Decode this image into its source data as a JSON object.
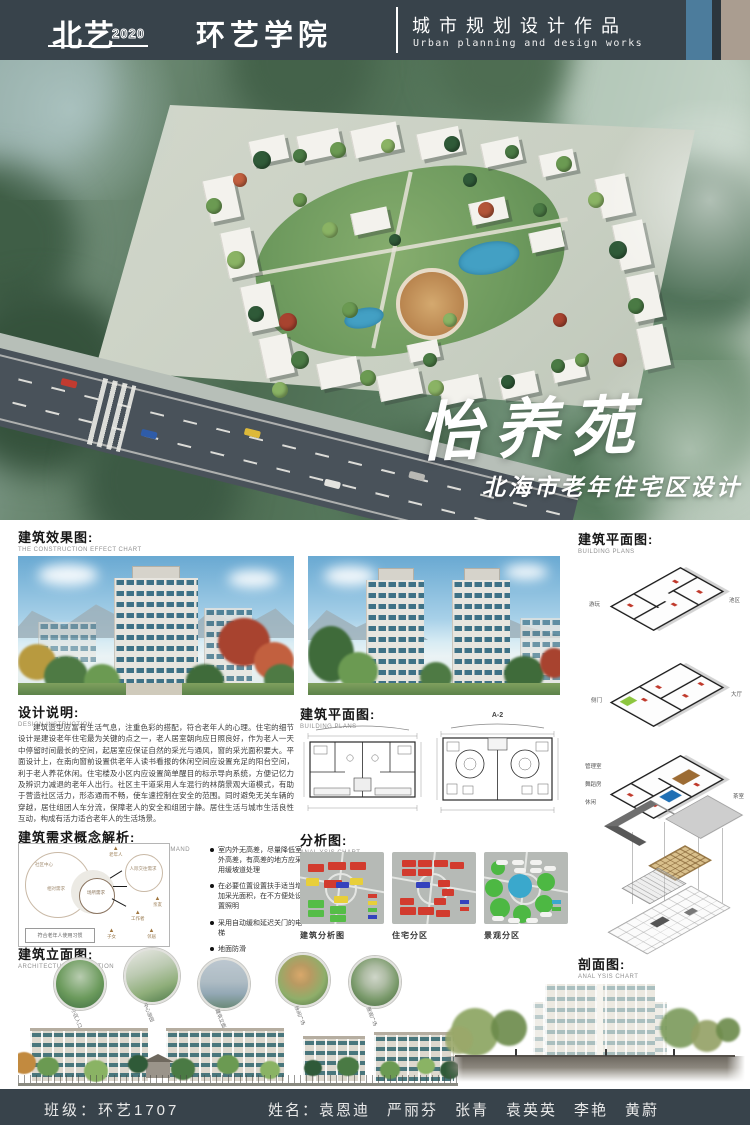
{
  "header": {
    "brand": "北艺",
    "brand_year": "2020",
    "department": "环艺学院",
    "category_cn": "城市规划设计作品",
    "category_en": "Urban planning and design works"
  },
  "hero": {
    "title": "怡养苑",
    "subtitle": "北海市老年住宅区设计"
  },
  "sections": {
    "effect": {
      "cn": "建筑效果图:",
      "en": "THE CONSTRUCTION EFFECT CHART"
    },
    "plans_right": {
      "cn": "建筑平面图:",
      "en": "BUILDING PLANS",
      "p1l": "游玩",
      "p1r": "池区",
      "p2l": "侧门",
      "p2r": "大厅",
      "p3l1": "管理室",
      "p3l2": "舞蹈房",
      "p3l3": "休闲",
      "p3r": "茶室"
    },
    "design": {
      "cn": "设计说明:",
      "en": "DESIGN INSTRUCTION",
      "body": "建筑造型应富有生活气息，注重色彩的搭配，符合老年人的心理。住宅的细节设计是建设老年住宅最为关键的点之一，老人居室朝向应日照良好，作为老人一天中停留时间最长的空间，起居室应保证自然的采光与通风，窗的采光面积要大。平面设计上，在南向窗前设置供老年人读书看报的休闲空间应设置充足的阳台空间，利于老人养花休闲。住宅楼及小区内应设置简单醒目的标示导向系统，方便记忆力及辨识力减退的老年人出行。社区主干道采用人车混行的林荫景观大道模式，有助于营造社区活力，形态通而不畅，使车速控制在安全的范围。同时避免无关车辆的穿越，居住组团人车分流，保障老人的安全和组团宁静。居住生活与城市生活良性互动，构成有活力适合老年人的生活场景。"
    },
    "plans_mid": {
      "cn": "建筑平面图:",
      "en": "BUILDING PLANS",
      "a1": "A-1",
      "a2": "A-2"
    },
    "demand": {
      "cn": "建筑需求概念解析:",
      "en": "ANALYSIS OF THE CONCEPT OF BUILDING DEMAND",
      "bullets": [
        "室内外无高差，尽量降低室外高差，有高差的地方应采用缓坡道处理",
        "在必要位置设置扶手适当增加采光面积，在不方便处设置照明",
        "采用自动缓和延迟关门的电梯",
        "地面防滑"
      ],
      "diagram": {
        "big": "社区中心",
        "mid": "相对需求",
        "center": "场所需求",
        "right": "人际交往需求",
        "a1": "老年人",
        "a2": "亲友",
        "a3": "工作者",
        "a4": "子女",
        "a5": "邻居",
        "note": "符合老年人使用习惯"
      }
    },
    "analysis": {
      "cn": "分析图:",
      "en": "ANAL YSIS CHART",
      "c1": "建筑分析图",
      "c2": "住宅分区",
      "c3": "景观分区"
    },
    "elevation": {
      "cn": "建筑立面图:",
      "en": "ARCHITECTURAL ELEVATION",
      "i1": "小区入口",
      "i2": "中心游园",
      "i3": "建筑立面",
      "i4": "休闲广场",
      "i5": "景观广场"
    },
    "section_view": {
      "cn": "剖面图:",
      "en": "ANAL YSIS CHART"
    }
  },
  "footer": {
    "class_info": "班级：环艺1707",
    "names": "姓名：袁恩迪　严丽芬　张青　袁英英　李艳　黄蔚"
  }
}
